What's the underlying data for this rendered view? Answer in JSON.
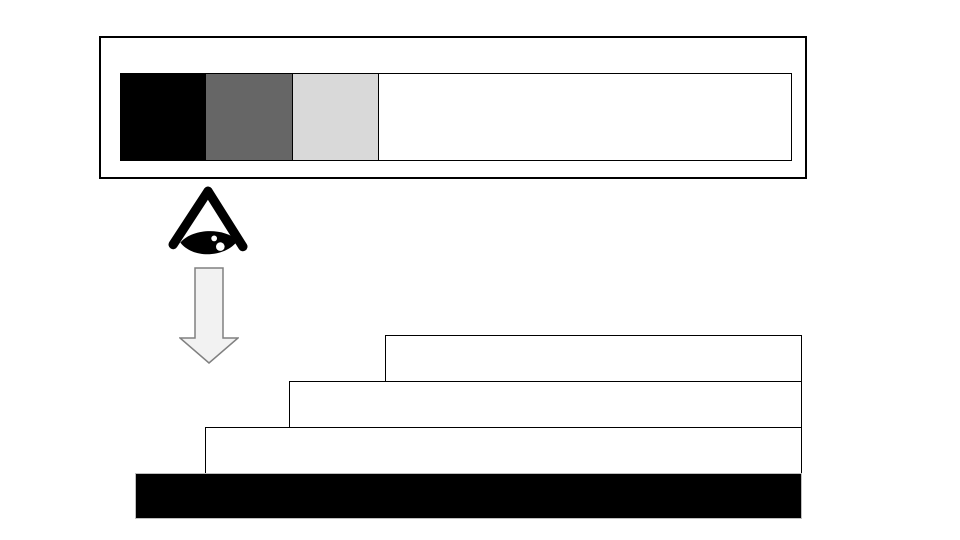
{
  "page": {
    "background": "#ffffff"
  },
  "icons": {
    "eye": "eye-icon",
    "arrow": "down-arrow-icon"
  },
  "top_box": {
    "fill": "#ffffff",
    "border": "#000000",
    "inner_bar": {
      "fill": "#ffffff",
      "border": "#000000"
    },
    "segments": [
      {
        "color": "#000000"
      },
      {
        "color": "#666666"
      },
      {
        "color": "#d9d9d9"
      }
    ]
  },
  "eye_icon": {
    "color": "#000000",
    "highlight": "#ffffff"
  },
  "down_arrow": {
    "fill": "#f2f2f2",
    "stroke": "#808080"
  },
  "stack": {
    "rows": [
      {
        "fill": "#ffffff",
        "border": "#000000"
      },
      {
        "fill": "#ffffff",
        "border": "#000000"
      },
      {
        "fill": "#ffffff",
        "border": "#000000"
      }
    ],
    "base_bar": {
      "fill": "#000000",
      "border": "#bfbfbf"
    }
  }
}
